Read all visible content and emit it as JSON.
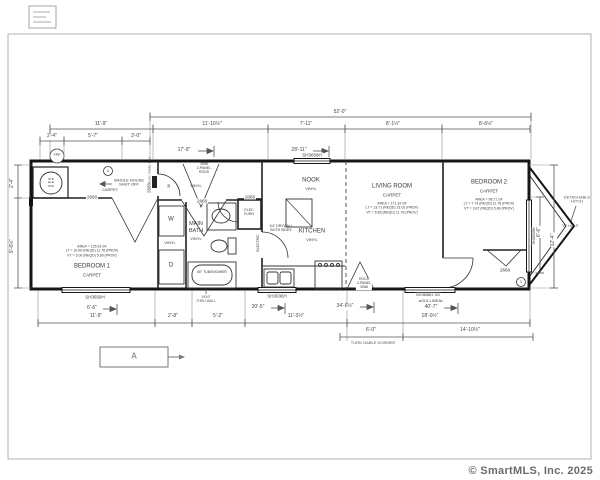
{
  "frame": {
    "watermark": "© SmartMLS, Inc. 2025"
  },
  "dimensions": {
    "top_overall": "52'-0\"",
    "top_row": [
      "11'-9\"",
      "11'-10½\"",
      "7'-11\"",
      "8'-1½\"",
      "8'-6½\""
    ],
    "top_sub": [
      "2'-4\"",
      "5'-7\"",
      "3'-0\""
    ],
    "top_leaders": [
      "17'-9\"",
      "28'-11\""
    ],
    "bottom_leaders": [
      "6'-6\"",
      "20'-5\"",
      "34'-6½\"",
      "40'-7\""
    ],
    "bottom_row": [
      "11'-9\"",
      "2'-8\"",
      "5'-2\"",
      "11'-3½\"",
      "18'-0½\""
    ],
    "bottom_row2": [
      "6'-0\"",
      "14'-10½\""
    ],
    "left": [
      "2'-4\"",
      "9'-6½\""
    ],
    "right": [
      "6'-6\"",
      "12'-4\""
    ]
  },
  "rooms": {
    "bedroom1": {
      "name": "BEDROOM 1",
      "floor": "CARPET",
      "stats": [
        "AREA = 125.03 SF",
        "LT = 10.00 (REQD) 11.78 (PROV)",
        "VT = 5.00 (REQD) 5.89 (PROV)"
      ]
    },
    "main_bath": {
      "name": [
        "MAIN",
        "BATH"
      ],
      "floor": "VINYL"
    },
    "kitchen": {
      "name": "KITCHEN",
      "floor": "VINYL"
    },
    "nook": {
      "name": "NOOK",
      "floor": "VINYL"
    },
    "living_room": {
      "name": "LIVING ROOM",
      "floor": "CARPET",
      "stats": [
        "AREA = 171.32 SF",
        "LT = 13.71 (REQD) 23.02 (PROV)",
        "VT = 6.85 (REQD) 11.78 (PROV)"
      ]
    },
    "bedroom2": {
      "name": "BEDROOM 2",
      "floor": "CARPET",
      "stats": [
        "AREA = 98.71 SF",
        "LT = 7.74 (REQD) 11.78 (PROV)",
        "VT = 3.87 (REQD) 5.89 (PROV)"
      ]
    },
    "hall": {
      "floor": "VINYL"
    },
    "laundry": {
      "floor": "VINYL"
    },
    "entry": {
      "floor": "CARPET"
    }
  },
  "doors": {
    "d2668": "2668",
    "d2868": "2868",
    "d2068": "2068",
    "closet3068": [
      "3068",
      "2-PANEL",
      "RODS"
    ],
    "living3068": [
      "RODS",
      "2-PANEL",
      "3068"
    ]
  },
  "windows": {
    "sh3658h": "SH3658H",
    "sh3036h": "SH3036H",
    "sh3658h_sg": [
      "SH3658H SG",
      "w/3.5 LINEAL"
    ]
  },
  "markers": {
    "fpp": "FPP",
    "circle1": "1",
    "half_label": "\"A\" HALF",
    "section_a": "A",
    "detachable_hitch": [
      "DETACHABLE",
      "HITCH"
    ],
    "turn_gable_dormer": "TURN GABLE DORMER",
    "vent_thru_wall": [
      "VENT",
      "THRU WALL"
    ],
    "water_heater": [
      "STD",
      "ELE",
      "W/H"
    ],
    "whole_house_shut_off": [
      "WHOLE HOUSE",
      "SHUT OFF"
    ],
    "drywall_note": [
      "1/4\" DRYWALL",
      "BOTH SIDES"
    ],
    "electric": "ELECTRIC",
    "elec_panel": "ELEC. PANEL BOX",
    "hall_width": "36",
    "washer": "W",
    "dryer": "D",
    "tub": "60\" TUB/SHOWER",
    "elec_furn": [
      "ELEC",
      "FURN"
    ]
  }
}
